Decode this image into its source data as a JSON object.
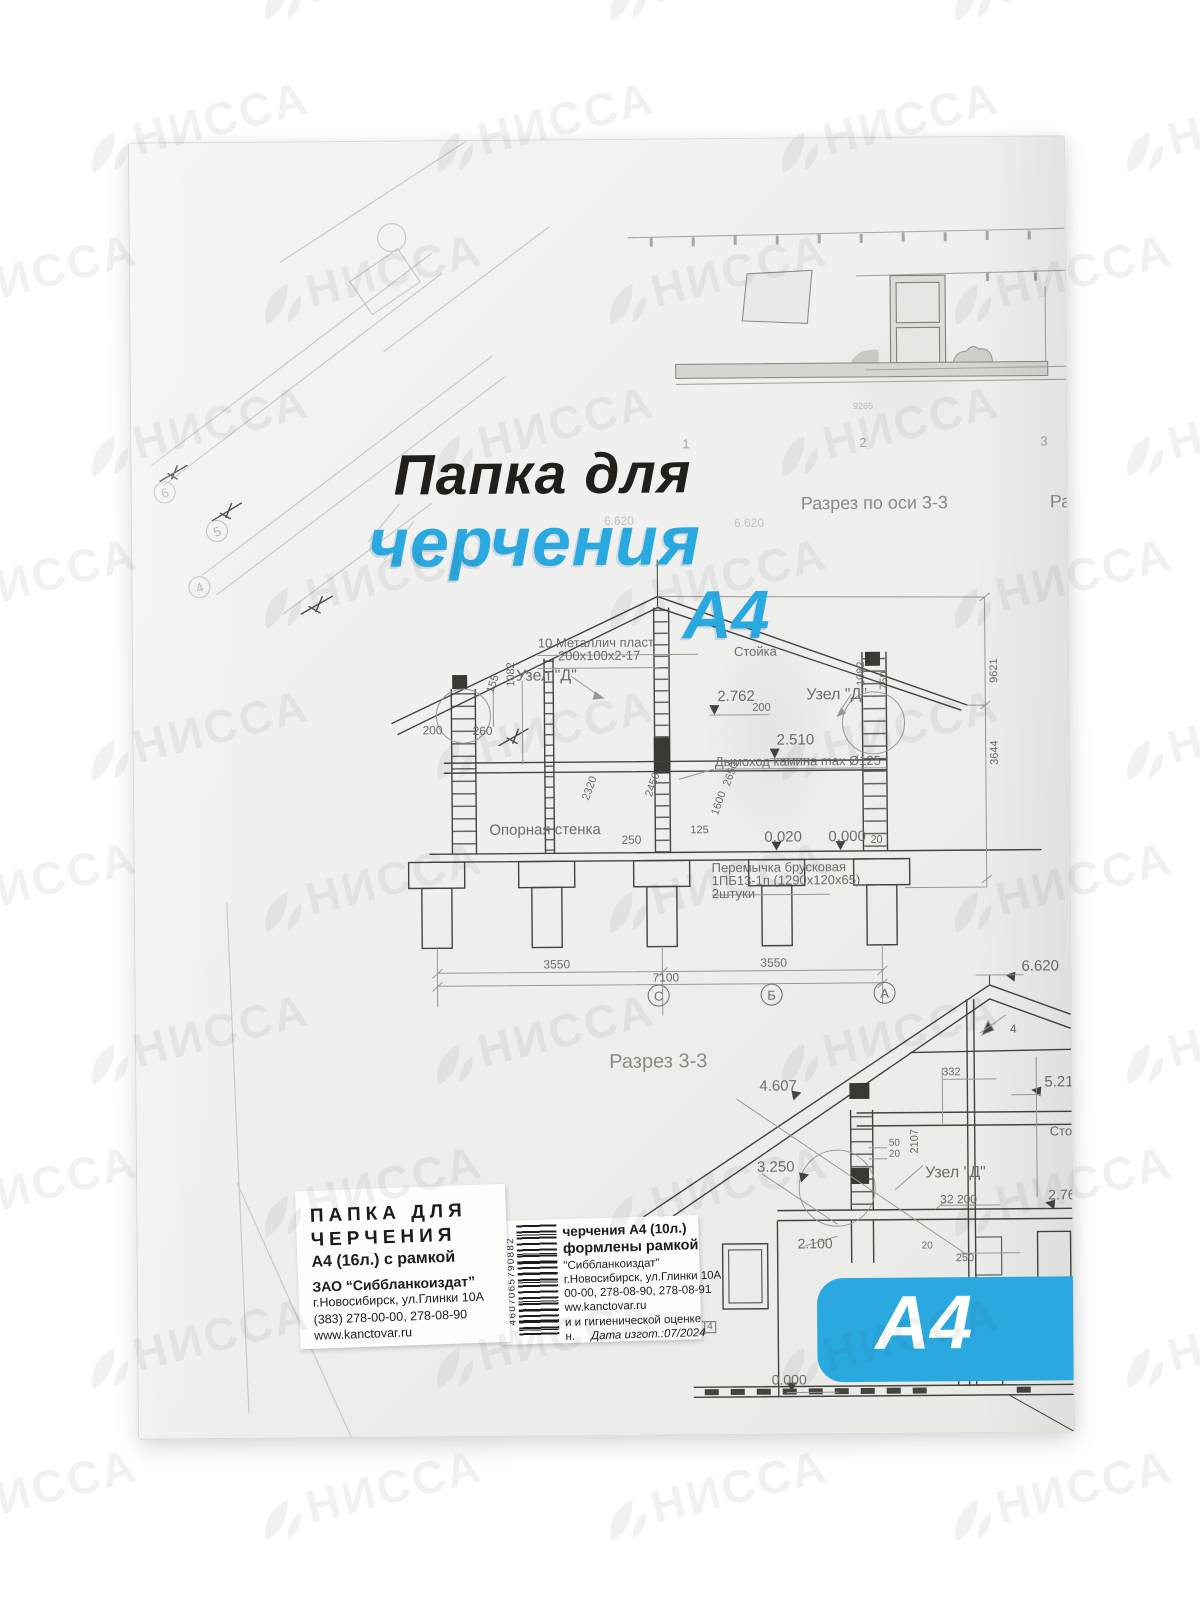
{
  "product": {
    "title_line1": "Папка для",
    "title_line2": "черчения",
    "title_line3": "А4",
    "badge_label": "А4"
  },
  "colors": {
    "accent_blue": "#2aa9e1",
    "title_black": "#221f1a",
    "drawing_dark": "#45433e",
    "drawing_light": "#9a9893",
    "label_gray": "#6e6c66"
  },
  "watermark": {
    "text": "НИССА",
    "icon": "nissa-leaf-icon"
  },
  "blueprint": {
    "heading_top": "Разрез по оси 3-3",
    "heading_top_fragment": "Ра",
    "heading_bottom": "Разрез 3-3",
    "labels": [
      {
        "t": "Разрез по оси 3-3",
        "x": 669,
        "y": 356,
        "fs": 18,
        "c": "#8b8983"
      },
      {
        "t": "Ра",
        "x": 918,
        "y": 356,
        "fs": 18,
        "c": "#8b8983"
      },
      {
        "t": "6.620",
        "x": 472,
        "y": 375,
        "fs": 12,
        "c": "#c2c2bc"
      },
      {
        "t": "6.620",
        "x": 602,
        "y": 378,
        "fs": 12,
        "c": "#c2c2bc"
      },
      {
        "t": "9265",
        "x": 722,
        "y": 264,
        "fs": 9,
        "c": "#b8b8b2"
      },
      {
        "t": "1",
        "x": 551,
        "y": 298,
        "fs": 13,
        "c": "#a3a39d"
      },
      {
        "t": "2",
        "x": 728,
        "y": 298,
        "fs": 13,
        "c": "#a3a39d"
      },
      {
        "t": "3",
        "x": 909,
        "y": 298,
        "fs": 13,
        "c": "#a3a39d"
      },
      {
        "t": "10 Металлич пласт",
        "x": 405,
        "y": 496,
        "fs": 13
      },
      {
        "t": "200х100х2-17",
        "x": 425,
        "y": 509,
        "fs": 13
      },
      {
        "t": "Узел \"Д\"",
        "x": 383,
        "y": 528,
        "fs": 16
      },
      {
        "t": "155",
        "x": 352,
        "y": 550,
        "fs": 11,
        "r": -70
      },
      {
        "t": "1082",
        "x": 373,
        "y": 546,
        "fs": 11,
        "r": -90
      },
      {
        "t": "200",
        "x": 289,
        "y": 583,
        "fs": 12
      },
      {
        "t": "260",
        "x": 339,
        "y": 584,
        "fs": 12
      },
      {
        "t": "Стойка",
        "x": 601,
        "y": 506,
        "fs": 13
      },
      {
        "t": "2.762",
        "x": 584,
        "y": 550,
        "fs": 15
      },
      {
        "t": "200",
        "x": 619,
        "y": 564,
        "fs": 11
      },
      {
        "t": "Узел \"Д\"",
        "x": 673,
        "y": 549,
        "fs": 16
      },
      {
        "t": "1082",
        "x": 723,
        "y": 548,
        "fs": 11,
        "r": -90
      },
      {
        "t": "750",
        "x": 746,
        "y": 552,
        "fs": 11,
        "r": -90
      },
      {
        "t": "2.510",
        "x": 643,
        "y": 594,
        "fs": 15
      },
      {
        "t": "Дымоход камина max Ø125",
        "x": 581,
        "y": 616,
        "fs": 13
      },
      {
        "t": "9621",
        "x": 856,
        "y": 546,
        "fs": 11,
        "r": -90
      },
      {
        "t": "3644",
        "x": 856,
        "y": 628,
        "fs": 11,
        "r": -90
      },
      {
        "t": "2320",
        "x": 447,
        "y": 658,
        "fs": 11,
        "r": -70
      },
      {
        "t": "2450",
        "x": 510,
        "y": 655,
        "fs": 11,
        "r": -70
      },
      {
        "t": "2650",
        "x": 588,
        "y": 645,
        "fs": 11,
        "r": -70
      },
      {
        "t": "1600",
        "x": 576,
        "y": 674,
        "fs": 11,
        "r": -70
      },
      {
        "t": "125",
        "x": 556,
        "y": 686,
        "fs": 11
      },
      {
        "t": "250",
        "x": 487,
        "y": 694,
        "fs": 12
      },
      {
        "t": "Опорная стенка",
        "x": 355,
        "y": 682,
        "fs": 15
      },
      {
        "t": "0.020",
        "x": 630,
        "y": 691,
        "fs": 15
      },
      {
        "t": "0.000",
        "x": 694,
        "y": 691,
        "fs": 15
      },
      {
        "t": "20",
        "x": 736,
        "y": 697,
        "fs": 11
      },
      {
        "t": "Перемычка брусковая",
        "x": 577,
        "y": 722,
        "fs": 13
      },
      {
        "t": "1ПБ13-1п (1290х120х65)",
        "x": 577,
        "y": 735,
        "fs": 13
      },
      {
        "t": "2штуки",
        "x": 577,
        "y": 748,
        "fs": 13
      },
      {
        "t": "3550",
        "x": 408,
        "y": 818,
        "fs": 12
      },
      {
        "t": "7100",
        "x": 517,
        "y": 832,
        "fs": 12
      },
      {
        "t": "3550",
        "x": 625,
        "y": 818,
        "fs": 12
      },
      {
        "t": "Разрез 3-3",
        "x": 473,
        "y": 912,
        "fs": 20,
        "c": "#8b8983"
      },
      {
        "t": "4.607",
        "x": 623,
        "y": 940,
        "fs": 15
      },
      {
        "t": "332",
        "x": 806,
        "y": 930,
        "fs": 11
      },
      {
        "t": "5.210",
        "x": 908,
        "y": 938,
        "fs": 15
      },
      {
        "t": "6.620",
        "x": 886,
        "y": 822,
        "fs": 15
      },
      {
        "t": "4",
        "x": 874,
        "y": 886,
        "fs": 12
      },
      {
        "t": "3.250",
        "x": 620,
        "y": 1021,
        "fs": 15
      },
      {
        "t": "50",
        "x": 752,
        "y": 1001,
        "fs": 10
      },
      {
        "t": "20",
        "x": 752,
        "y": 1012,
        "fs": 10
      },
      {
        "t": "2107",
        "x": 773,
        "y": 1016,
        "fs": 11,
        "r": -90
      },
      {
        "t": "Узел \"Д\"",
        "x": 788,
        "y": 1028,
        "fs": 16
      },
      {
        "t": "32 200",
        "x": 803,
        "y": 1056,
        "fs": 12
      },
      {
        "t": "2.76",
        "x": 911,
        "y": 1051,
        "fs": 14
      },
      {
        "t": "Стой",
        "x": 913,
        "y": 988,
        "fs": 13
      },
      {
        "t": "2.100",
        "x": 660,
        "y": 1098,
        "fs": 14
      },
      {
        "t": "20",
        "x": 784,
        "y": 1104,
        "fs": 10
      },
      {
        "t": "250",
        "x": 818,
        "y": 1116,
        "fs": 11
      },
      {
        "t": "0.000",
        "x": 633,
        "y": 1234,
        "fs": 14
      },
      {
        "t": "4",
        "x": 566,
        "y": 1182,
        "fs": 10,
        "boxed": true
      }
    ],
    "grid_circles": [
      {
        "t": "С",
        "x": 512,
        "y": 845
      },
      {
        "t": "Б",
        "x": 625,
        "y": 845
      },
      {
        "t": "А",
        "x": 738,
        "y": 844
      },
      {
        "t": "6",
        "x": 22,
        "y": 338,
        "faint": true,
        "r": -20
      },
      {
        "t": "5",
        "x": 74,
        "y": 377,
        "faint": true,
        "r": -20
      },
      {
        "t": "4",
        "x": 56,
        "y": 433,
        "faint": true,
        "r": -20
      }
    ]
  },
  "sticker_left": {
    "line1": "ПАПКА ДЛЯ",
    "line2": "ЧЕРЧЕНИЯ",
    "line3": "А4 (16л.) с рамкой",
    "line4": "ЗАО “Сиббланкоиздат”",
    "line5": "г.Новосибирск, ул.Глинки 10А",
    "line6": "(383) 278-00-00, 278-08-90",
    "line7": "www.kanctovar.ru"
  },
  "sticker_right": {
    "line1": "черчения А4 (10л.)",
    "line2": "формлены рамкой",
    "line3": "\"Сиббланкоиздат\"",
    "line4": "г.Новосибирск, ул.Глинки 10А",
    "line5": "00-00, 278-08-90, 278-08-91",
    "line6": "ww.kanctovar.ru",
    "line7": "и и гигиенической оценке.",
    "line8_left": "н.",
    "line8_date": "Дата изгот.:07/2024"
  },
  "barcode": {
    "digits": "4607065790882"
  }
}
